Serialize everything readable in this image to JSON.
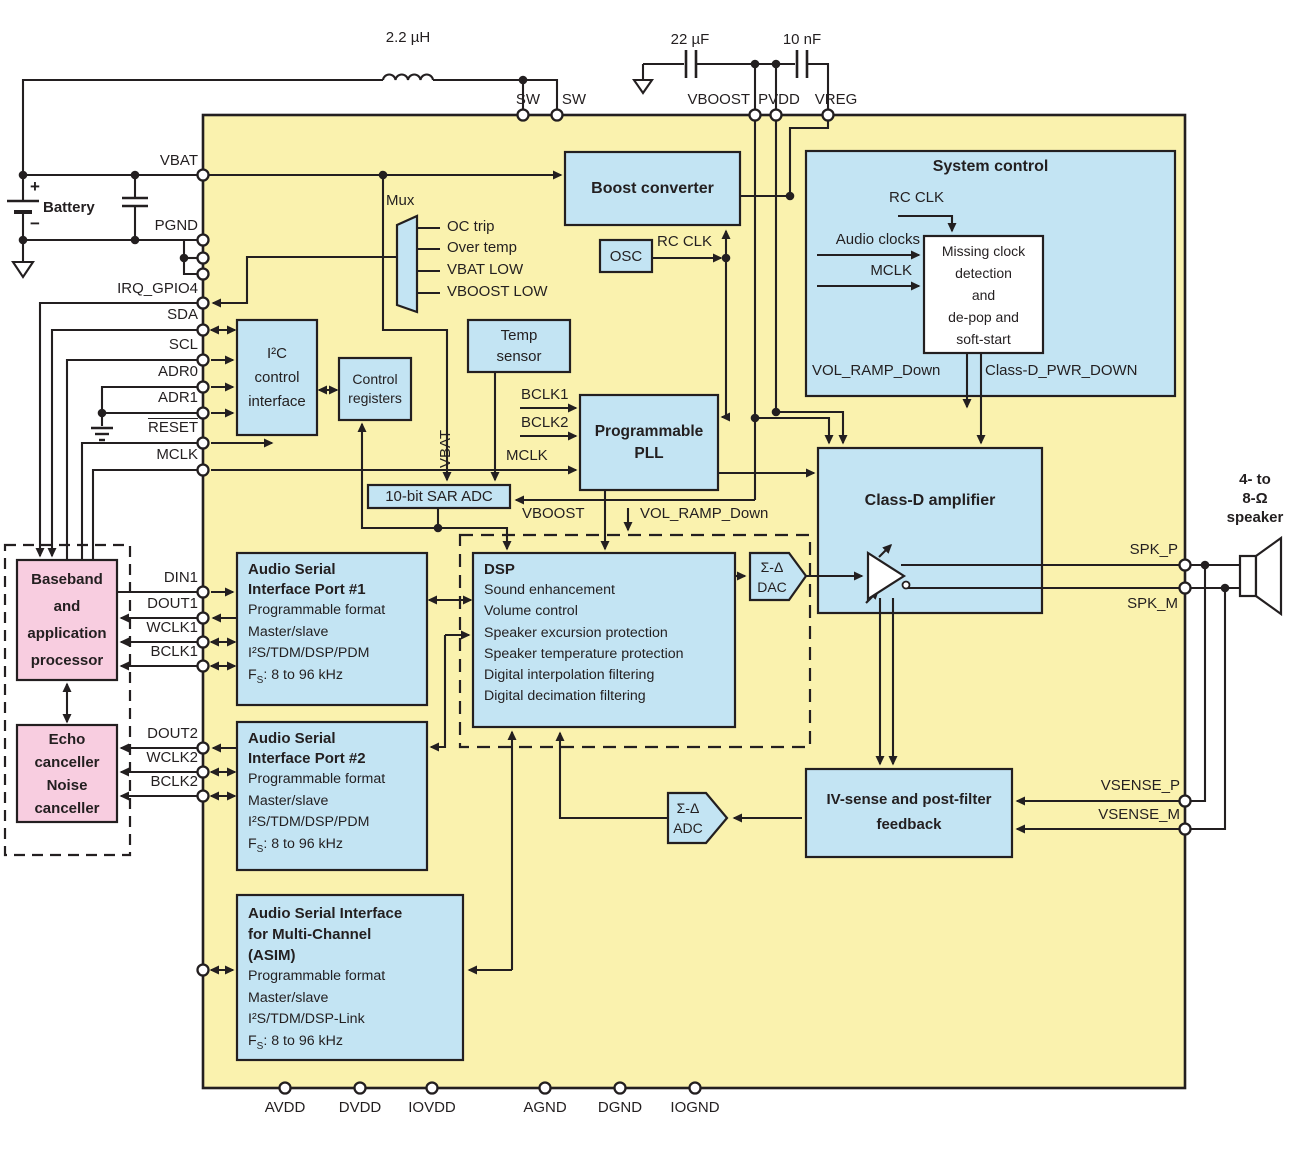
{
  "colors": {
    "chip": "#faf2ae",
    "block": "#c3e4f3",
    "pink": "#f8cde0",
    "line": "#231f20",
    "white": "#ffffff"
  },
  "top": {
    "inductor": "2.2 µH",
    "cap1": "22 µF",
    "cap2": "10 nF",
    "pin_sw1": "SW",
    "pin_sw2": "SW",
    "pin_vboost": "VBOOST",
    "pin_pvdd": "PVDD",
    "pin_vreg": "VREG"
  },
  "battery": {
    "plus": "+",
    "minus": "−",
    "label": "Battery"
  },
  "left_pins": {
    "vbat": "VBAT",
    "pgnd": "PGND",
    "irq": "IRQ_GPIO4",
    "sda": "SDA",
    "scl": "SCL",
    "adr0": "ADR0",
    "adr1": "ADR1",
    "reset": "RESET",
    "mclk": "MCLK",
    "din1": "DIN1",
    "dout1": "DOUT1",
    "wclk1": "WCLK1",
    "bclk1": "BCLK1",
    "dout2": "DOUT2",
    "wclk2": "WCLK2",
    "bclk2": "BCLK2"
  },
  "baseband": {
    "lines": [
      "Baseband",
      "and",
      "application",
      "processor"
    ]
  },
  "echo": {
    "lines": [
      "Echo",
      "canceller",
      "Noise",
      "canceller"
    ]
  },
  "boost": "Boost converter",
  "osc": {
    "label": "OSC",
    "rc_clk": "RC CLK"
  },
  "system_control": {
    "title": "System control",
    "rc_clk": "RC CLK",
    "audio_clocks": "Audio clocks",
    "mclk": "MCLK",
    "missing": [
      "Missing clock",
      "detection",
      "and",
      "de-pop and",
      "soft-start"
    ],
    "vol_ramp": "VOL_RAMP_Down",
    "pwr_down": "Class-D_PWR_DOWN"
  },
  "mux": {
    "title": "Mux",
    "items": [
      "OC trip",
      "Over temp",
      "VBAT LOW",
      "VBOOST LOW"
    ]
  },
  "i2c": {
    "lines": [
      "I²C",
      "control",
      "interface"
    ]
  },
  "control_registers": {
    "lines": [
      "Control",
      "registers"
    ]
  },
  "temp_sensor": {
    "lines": [
      "Temp",
      "sensor"
    ]
  },
  "pll": {
    "lines": [
      "Programmable",
      "PLL"
    ],
    "bclk1": "BCLK1",
    "bclk2": "BCLK2",
    "mclk": "MCLK"
  },
  "sar_adc": "10-bit SAR ADC",
  "taps": {
    "vbat": "VBAT",
    "vboost": "VBOOST",
    "vol_ramp": "VOL_RAMP_Down"
  },
  "dsp": {
    "title": "DSP",
    "lines": [
      "Sound enhancement",
      "Volume control",
      "Speaker excursion protection",
      "Speaker temperature protection",
      "Digital interpolation filtering",
      "Digital decimation filtering"
    ]
  },
  "dac": {
    "lines": [
      "Σ-Δ",
      "DAC"
    ]
  },
  "adc": {
    "lines": [
      "Σ-Δ",
      "ADC"
    ]
  },
  "class_d": "Class-D amplifier",
  "iv_sense": {
    "lines": [
      "IV-sense and post-filter",
      "feedback"
    ]
  },
  "port1": {
    "title": [
      "Audio Serial",
      "Interface Port #1"
    ],
    "feats": [
      "Programmable format",
      "Master/slave",
      "I²S/TDM/DSP/PDM"
    ],
    "fs": {
      "f": "F",
      "sub": "S",
      "rest": ": 8 to 96 kHz"
    }
  },
  "port2": {
    "title": [
      "Audio Serial",
      "Interface Port #2"
    ],
    "feats": [
      "Programmable format",
      "Master/slave",
      "I²S/TDM/DSP/PDM"
    ],
    "fs": {
      "f": "F",
      "sub": "S",
      "rest": ": 8 to 96 kHz"
    }
  },
  "asim": {
    "title": [
      "Audio Serial Interface",
      "for Multi-Channel",
      "(ASIM)"
    ],
    "feats": [
      "Programmable format",
      "Master/slave",
      "I²S/TDM/DSP-Link"
    ],
    "fs": {
      "f": "F",
      "sub": "S",
      "rest": ": 8 to 96 kHz"
    }
  },
  "right": {
    "spk_p": "SPK_P",
    "spk_m": "SPK_M",
    "vsense_p": "VSENSE_P",
    "vsense_m": "VSENSE_M",
    "speaker": [
      "4- to",
      "8-Ω",
      "speaker"
    ]
  },
  "bottom_pins": [
    "AVDD",
    "DVDD",
    "IOVDD",
    "AGND",
    "DGND",
    "IOGND"
  ]
}
